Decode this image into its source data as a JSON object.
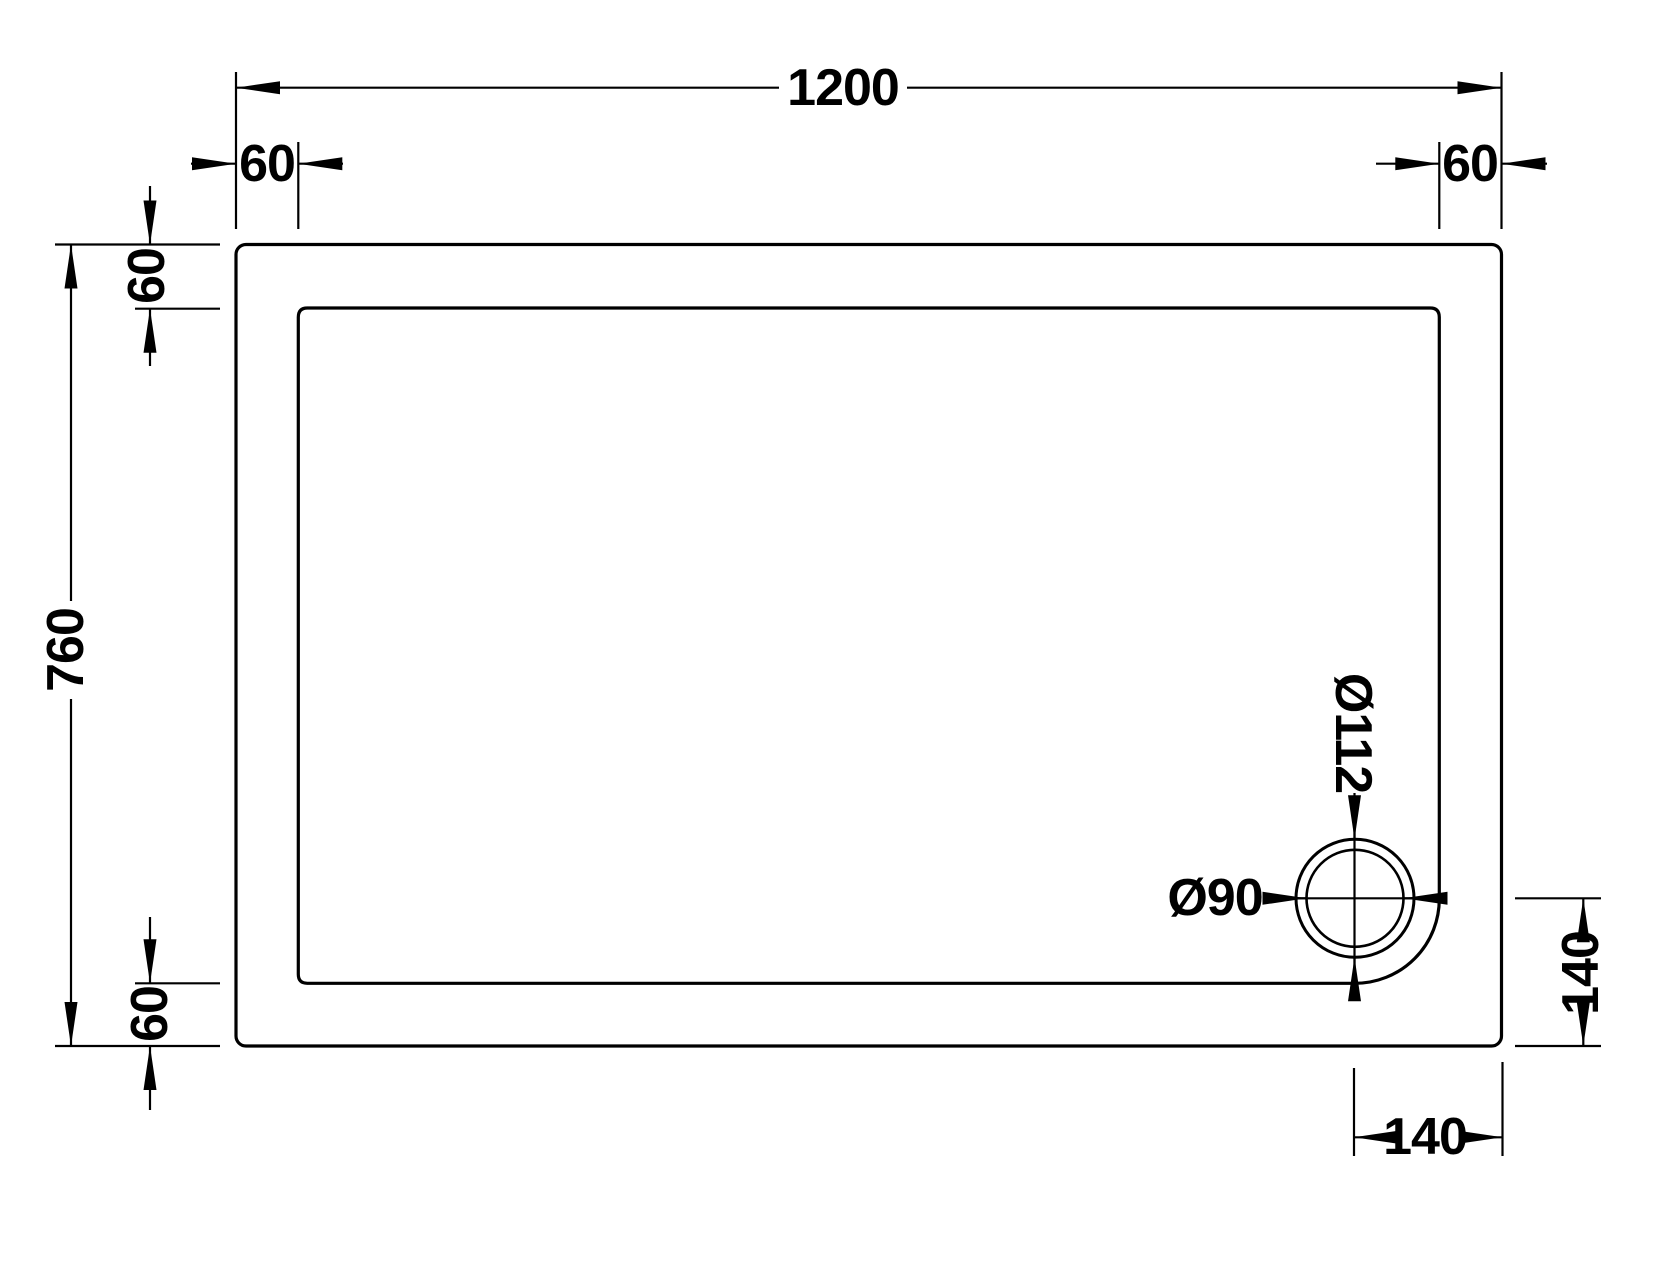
{
  "colors": {
    "line": "#000000",
    "background": "#ffffff"
  },
  "dimensions": {
    "overall_width": "1200",
    "overall_height": "760",
    "rim_top_left": "60",
    "rim_top_right": "60",
    "rim_left_top": "60",
    "rim_left_bottom": "60",
    "waste_outer_diameter": "Ø112",
    "waste_bore_diameter": "Ø90",
    "waste_offset_right": "140",
    "waste_offset_bottom": "140"
  }
}
